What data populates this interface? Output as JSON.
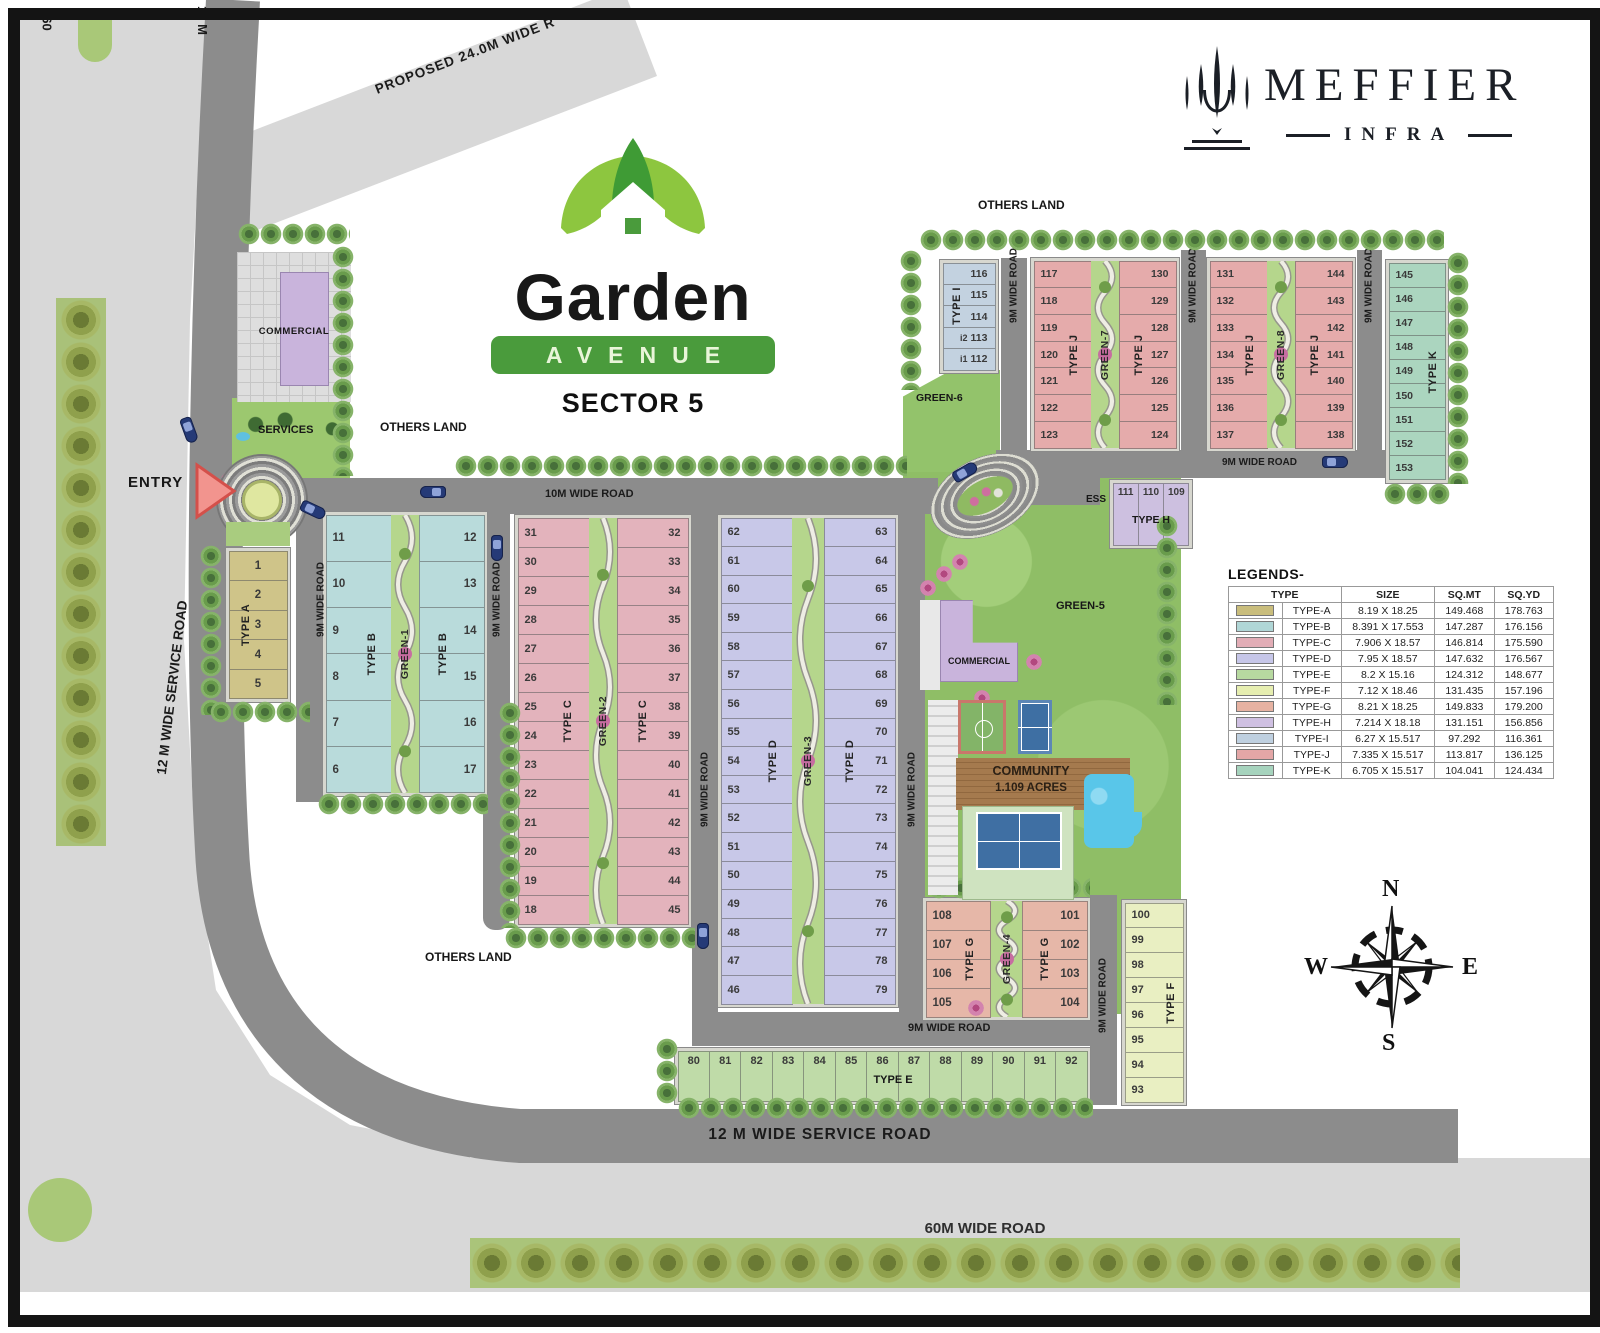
{
  "branding": {
    "developer": {
      "name": "MEFFIER",
      "sub": "INFRA"
    },
    "project": {
      "name": "Garden",
      "avenue": "AVENUE",
      "sector": "SECTOR 5"
    }
  },
  "labels": {
    "entry": "ENTRY",
    "others_land": "OTHERS LAND",
    "services": "SERVICES",
    "commercial": "COMMERCIAL",
    "ess": "ESS",
    "community_line1": "COMMUNITY",
    "community_line2": "1.109 ACRES",
    "legends_title": "LEGENDS-"
  },
  "roads": {
    "r60": "60",
    "r12m_top": "12 M",
    "proposed": "PROPOSED 24.0M WIDE R",
    "service_left": "12 M WIDE SERVICE ROAD",
    "service_bottom": "12 M  WIDE SERVICE ROAD",
    "r60m_bottom": "60M WIDE ROAD",
    "r10m": "10M WIDE ROAD",
    "r9m": "9M WIDE ROAD"
  },
  "greens": {
    "g1": "GREEN-1",
    "g2": "GREEN-2",
    "g3": "GREEN-3",
    "g4": "GREEN-4",
    "g5": "GREEN-5",
    "g6": "GREEN-6",
    "g7": "GREEN-7",
    "g8": "GREEN-8"
  },
  "compass": {
    "n": "N",
    "e": "E",
    "s": "S",
    "w": "W"
  },
  "blocks": {
    "A": {
      "type": "TYPE A",
      "plots": [
        "1",
        "2",
        "3",
        "4",
        "5"
      ]
    },
    "B": {
      "type": "TYPE B",
      "green": "GREEN-1",
      "left": [
        "11",
        "10",
        "9",
        "8",
        "7",
        "6"
      ],
      "right": [
        "12",
        "13",
        "14",
        "15",
        "16",
        "17"
      ]
    },
    "C": {
      "type": "TYPE C",
      "green": "GREEN-2",
      "left": [
        "31",
        "30",
        "29",
        "28",
        "27",
        "26",
        "25",
        "24",
        "23",
        "22",
        "21",
        "20",
        "19",
        "18"
      ],
      "right": [
        "32",
        "33",
        "34",
        "35",
        "36",
        "37",
        "38",
        "39",
        "40",
        "41",
        "42",
        "43",
        "44",
        "45"
      ]
    },
    "D": {
      "type": "TYPE D",
      "green": "GREEN-3",
      "left": [
        "62",
        "61",
        "60",
        "59",
        "58",
        "57",
        "56",
        "55",
        "54",
        "53",
        "52",
        "51",
        "50",
        "49",
        "48",
        "47",
        "46"
      ],
      "right": [
        "63",
        "64",
        "65",
        "66",
        "67",
        "68",
        "69",
        "70",
        "71",
        "72",
        "73",
        "74",
        "75",
        "76",
        "77",
        "78",
        "79"
      ]
    },
    "E": {
      "type": "TYPE E",
      "plots": [
        "80",
        "81",
        "82",
        "83",
        "84",
        "85",
        "86",
        "87",
        "88",
        "89",
        "90",
        "91",
        "92"
      ]
    },
    "F": {
      "type": "TYPE F",
      "plots": [
        "100",
        "99",
        "98",
        "97",
        "96",
        "95",
        "94",
        "93"
      ]
    },
    "G": {
      "type": "TYPE G",
      "green": "GREEN-4",
      "left": [
        "108",
        "107",
        "106",
        "105"
      ],
      "right": [
        "101",
        "102",
        "103",
        "104"
      ]
    },
    "H": {
      "type": "TYPE H",
      "plots": [
        "111",
        "110",
        "109"
      ]
    },
    "I": {
      "type": "TYPE I",
      "plots": [
        "116",
        "115",
        "114",
        "i2 113",
        "i1 112"
      ]
    },
    "J1": {
      "type": "TYPE J",
      "green": "GREEN-7",
      "left": [
        "117",
        "118",
        "119",
        "120",
        "121",
        "122",
        "123"
      ],
      "right": [
        "130",
        "129",
        "128",
        "127",
        "126",
        "125",
        "124"
      ]
    },
    "J2": {
      "type": "TYPE J",
      "green": "GREEN-8",
      "left": [
        "131",
        "132",
        "133",
        "134",
        "135",
        "136",
        "137"
      ],
      "right": [
        "144",
        "143",
        "142",
        "141",
        "140",
        "139",
        "138"
      ]
    },
    "K": {
      "type": "TYPE K",
      "plots": [
        "145",
        "146",
        "147",
        "148",
        "149",
        "150",
        "151",
        "152",
        "153"
      ]
    }
  },
  "legend": {
    "headers": [
      "TYPE",
      "SIZE",
      "SQ.MT",
      "SQ.YD"
    ],
    "rows": [
      {
        "type": "TYPE-A",
        "size": "8.19 X 18.25",
        "sqmt": "149.468",
        "sqyd": "178.763",
        "color": "#c9bd7c"
      },
      {
        "type": "TYPE-B",
        "size": "8.391 X 17.553",
        "sqmt": "147.287",
        "sqyd": "176.156",
        "color": "#b0d6d6"
      },
      {
        "type": "TYPE-C",
        "size": "7.906 X 18.57",
        "sqmt": "146.814",
        "sqyd": "175.590",
        "color": "#e2adb6"
      },
      {
        "type": "TYPE-D",
        "size": "7.95 X 18.57",
        "sqmt": "147.632",
        "sqyd": "176.567",
        "color": "#c6c6e8"
      },
      {
        "type": "TYPE-E",
        "size": "8.2 X 15.16",
        "sqmt": "124.312",
        "sqyd": "148.677",
        "color": "#b7d9a0"
      },
      {
        "type": "TYPE-F",
        "size": "7.12 X 18.46",
        "sqmt": "131.435",
        "sqyd": "157.196",
        "color": "#e6eeb0"
      },
      {
        "type": "TYPE-G",
        "size": "8.21  X 18.25",
        "sqmt": "149.833",
        "sqyd": "179.200",
        "color": "#e6b2a2"
      },
      {
        "type": "TYPE-H",
        "size": "7.214 X 18.18",
        "sqmt": "131.151",
        "sqyd": "156.856",
        "color": "#cfc0e2"
      },
      {
        "type": "TYPE-I",
        "size": "6.27 X 15.517",
        "sqmt": "97.292",
        "sqyd": "116.361",
        "color": "#bfd0e0"
      },
      {
        "type": "TYPE-J",
        "size": "7.335 X 15.517",
        "sqmt": "113.817",
        "sqyd": "136.125",
        "color": "#e3a6a6"
      },
      {
        "type": "TYPE-K",
        "size": "6.705 X 15.517",
        "sqmt": "104.041",
        "sqyd": "124.434",
        "color": "#a6d3bd"
      }
    ]
  }
}
